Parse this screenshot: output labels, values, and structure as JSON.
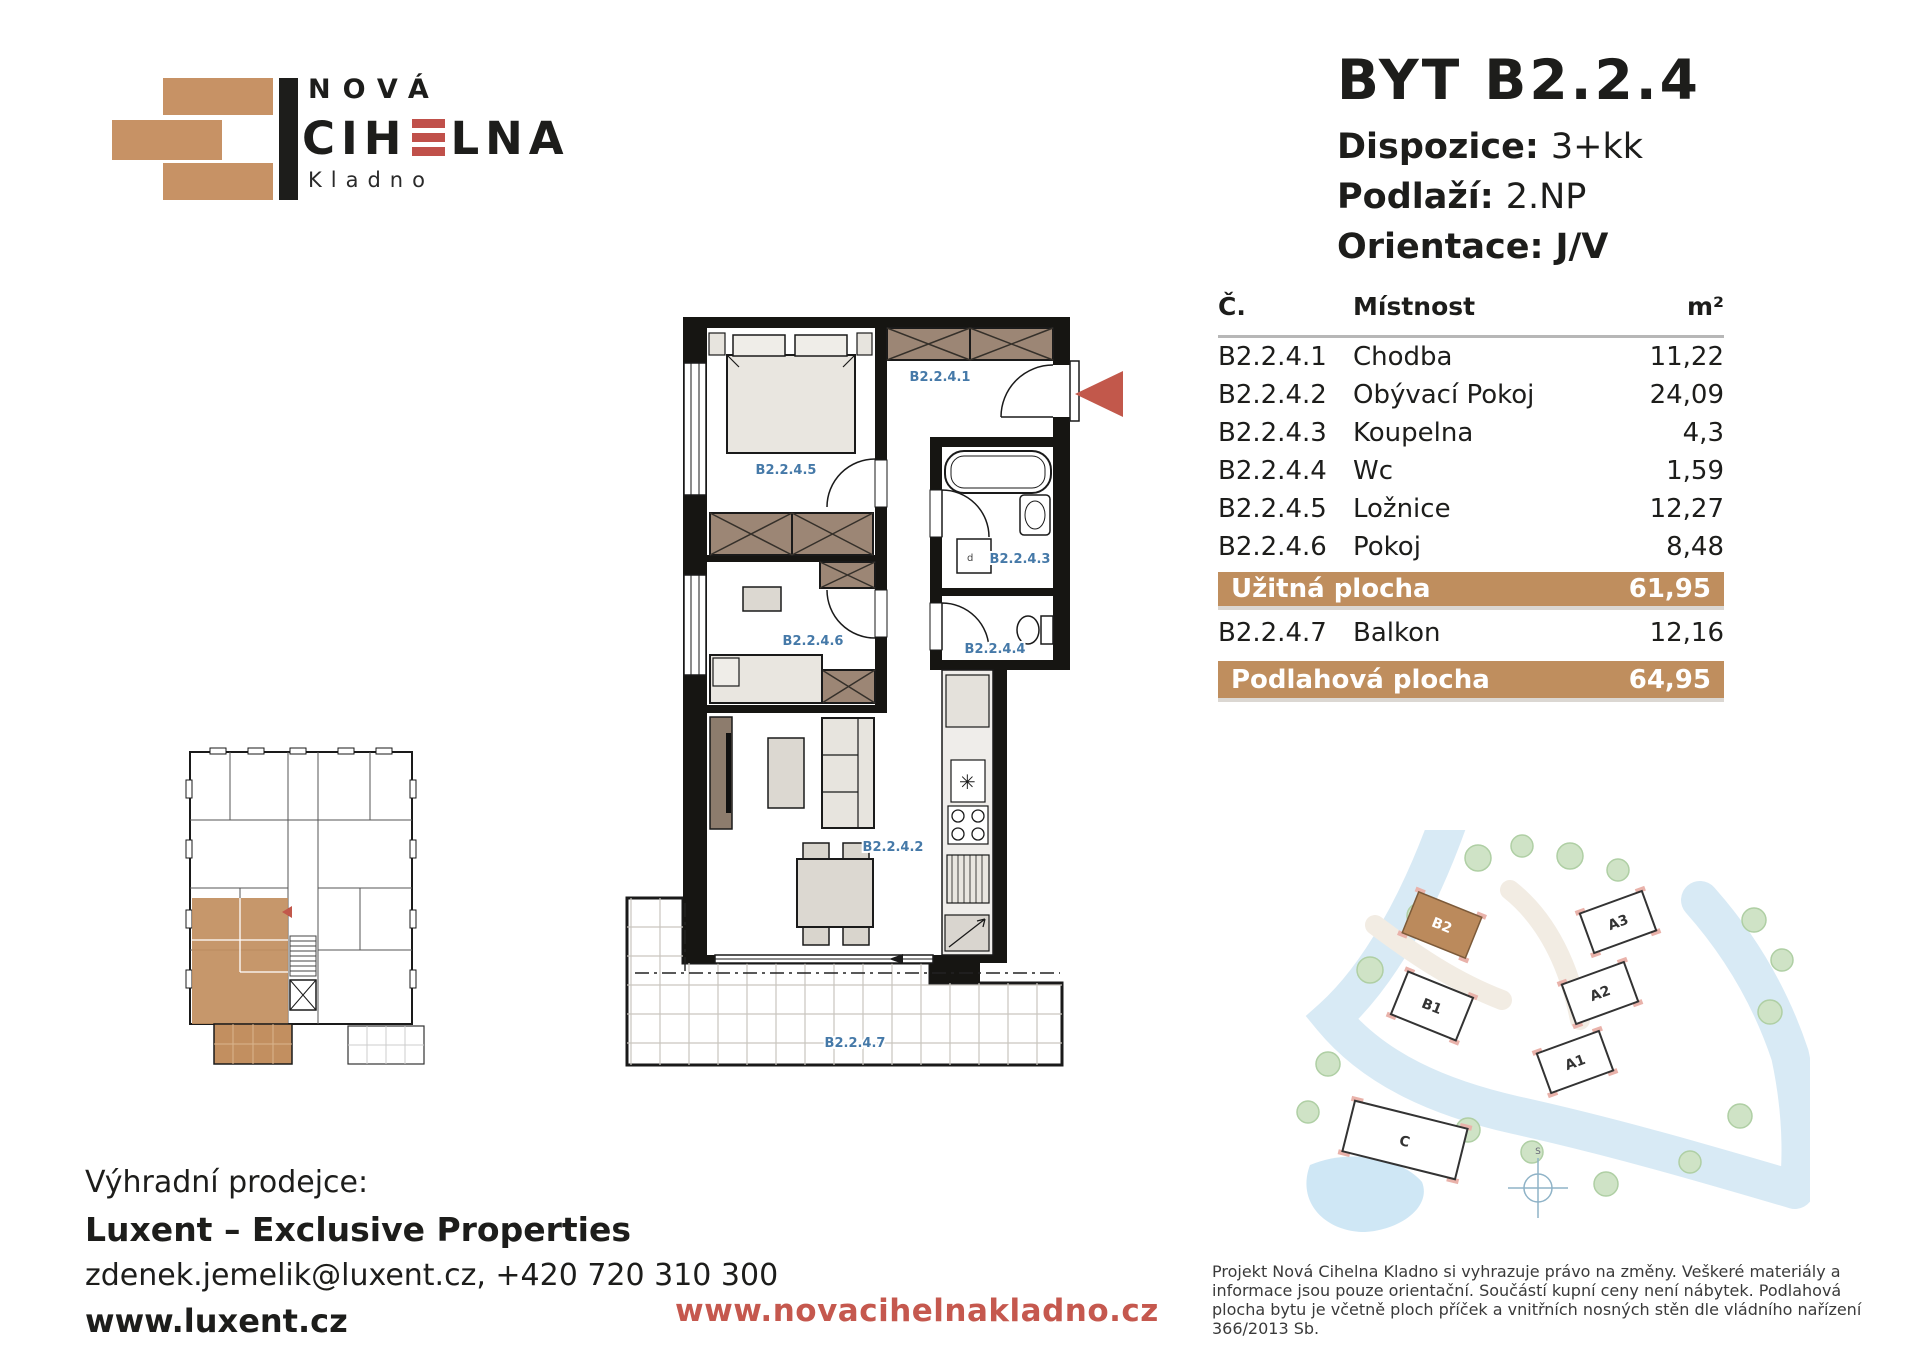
{
  "logo": {
    "top": "NOVÁ",
    "name_pre": "CIH",
    "name_post": "LNA",
    "city": "Kladno"
  },
  "header": {
    "title": "BYT B2.2.4",
    "specs": [
      {
        "label": "Dispozice:",
        "value": "3+kk"
      },
      {
        "label": "Podlaží:",
        "value": "2.NP"
      },
      {
        "label": "Orientace:",
        "value": "J/V"
      }
    ]
  },
  "table": {
    "headers": {
      "number": "Č.",
      "room": "Místnost",
      "area": "m²"
    },
    "rows": [
      {
        "number": "B2.2.4.1",
        "room": "Chodba",
        "area": "11,22"
      },
      {
        "number": "B2.2.4.2",
        "room": "Obývací Pokoj",
        "area": "24,09"
      },
      {
        "number": "B2.2.4.3",
        "room": "Koupelna",
        "area": "4,3"
      },
      {
        "number": "B2.2.4.4",
        "room": "Wc",
        "area": "1,59"
      },
      {
        "number": "B2.2.4.5",
        "room": "Ložnice",
        "area": "12,27"
      },
      {
        "number": "B2.2.4.6",
        "room": "Pokoj",
        "area": "8,48"
      }
    ],
    "useful_area": {
      "label": "Užitná plocha",
      "value": "61,95"
    },
    "balcony_row": {
      "number": "B2.2.4.7",
      "room": "Balkon",
      "area": "12,16"
    },
    "floor_area": {
      "label": "Podlahová plocha",
      "value": "64,95"
    }
  },
  "floor_plan": {
    "labels": {
      "chodba": "B2.2.4.1",
      "obyvaci_pokoj": "B2.2.4.2",
      "koupelna": "B2.2.4.3",
      "wc": "B2.2.4.4",
      "loznice": "B2.2.4.5",
      "pokoj": "B2.2.4.6",
      "balkon": "B2.2.4.7"
    },
    "washer_mark": "d"
  },
  "site_map": {
    "buildings": {
      "b2": "B2",
      "b1": "B1",
      "a1": "A1",
      "a2": "A2",
      "a3": "A3",
      "c": "C"
    },
    "highlighted": "B2",
    "compass": "S"
  },
  "footer": {
    "seller_intro": "Výhradní prodejce:",
    "seller_name": "Luxent – Exclusive Properties",
    "seller_contact": "zdenek.jemelik@luxent.cz, +420 720 310 300",
    "seller_web": "www.luxent.cz",
    "project_web": "www.novacihelnakladno.cz",
    "disclaimer": "Projekt Nová Cihelna Kladno si vyhrazuje právo na změny. Veškeré materiály a informace jsou pouze orientační. Součástí kupní ceny není nábytek. Podlahová plocha bytu je včetně ploch příček a vnitřních nosných stěn dle vládního nařízení 366/2013 Sb."
  },
  "colors": {
    "brand_tan": "#bf8e5e",
    "brand_red": "#c2584b",
    "plan_label_blue": "#4579a8"
  }
}
